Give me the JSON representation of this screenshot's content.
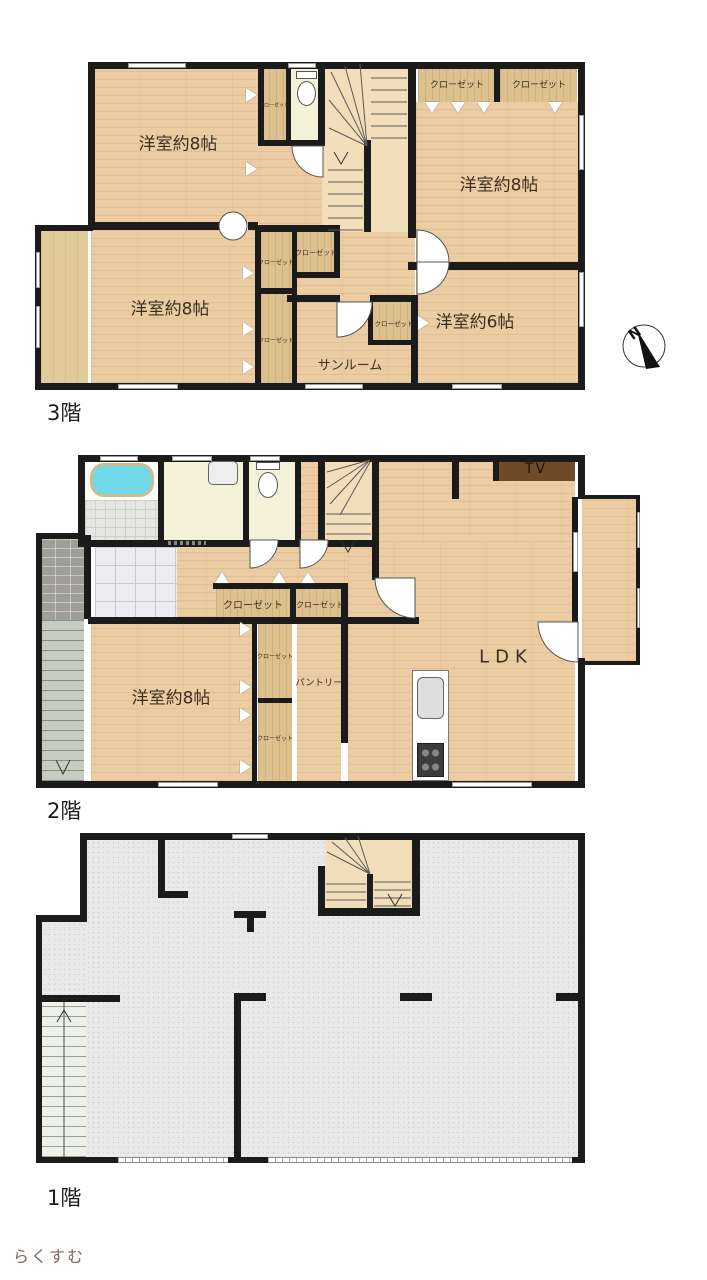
{
  "floors": {
    "f3": {
      "name": "3階",
      "bedroom_nw": "洋室約8帖",
      "bedroom_ne": "洋室約8帖",
      "bedroom_sw": "洋室約8帖",
      "bedroom_se": "洋室約6帖",
      "sunroom": "サンルーム",
      "closet": "クローゼット"
    },
    "f2": {
      "name": "2階",
      "ldk": "LDK",
      "bedroom": "洋室約8帖",
      "pantry": "パントリー",
      "closet": "クローゼット",
      "tv_label": "TV"
    },
    "f1": {
      "name": "1階"
    }
  },
  "compass": {
    "north": "N"
  },
  "brand": {
    "name": "らくすむ"
  },
  "colors": {
    "wall": "#1b1b1b",
    "wood_floor": "#eccda3",
    "closet_wood": "#dcc08d",
    "concrete": "#e9e9e9",
    "bathtub": "#6fd9e7",
    "tv_board": "#6e4a29",
    "logo_green": "#b5c13a",
    "logo_brown": "#5d4a42"
  }
}
